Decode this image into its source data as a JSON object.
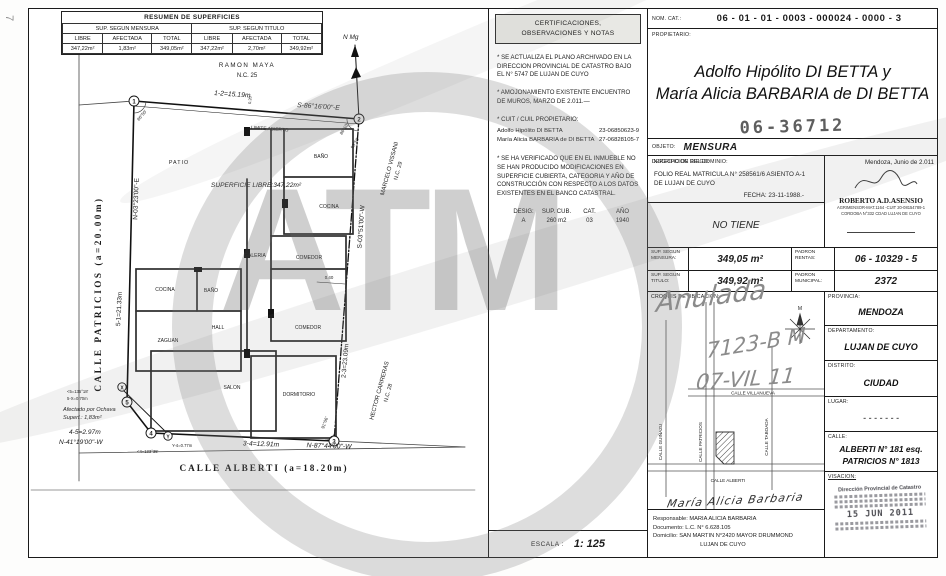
{
  "corner_mark": "7",
  "watermark": {
    "text": "ATM"
  },
  "summary_table": {
    "title": "RESUMEN DE SUPERFICIES",
    "group_mensura": "SUP. SEGUN MENSURA",
    "group_titulo": "SUP. SEGUN TITULO",
    "col_libre": "LIBRE",
    "col_afectada": "AFECTADA",
    "col_total": "TOTAL",
    "mensura": [
      "347,22m²",
      "1,83m²",
      "349,05m²"
    ],
    "titulo": [
      "347,22m²",
      "2,70m²",
      "349,92m²"
    ]
  },
  "plan": {
    "north_label": "N Mg",
    "top_tick": "0.20",
    "street_left": "CALLE  PATRICIOS  (a=20.00m)",
    "street_bottom": "CALLE  ALBERTI   (a=18.20m)",
    "neighbor_top": "RAMON  MAYA",
    "neighbor_top_nc": "N.C. 25",
    "neighbor_right1": "MARCELO VISSANI",
    "neighbor_right1_nc": "N.C. 29",
    "neighbor_right2": "HECTOR CARRERAS",
    "neighbor_right2_nc": "N.C. 28",
    "top_len": "1-2=15.19m",
    "top_bearing": "S-86°16'00\"-E",
    "top_note": "LIMITE ABIERTO",
    "left_bearing": "N-03°23'00\"-E",
    "left_len": "5-1=21.33m",
    "right_bearing": "S-03°51'00\"-W",
    "right_len": "2-3=23.09m",
    "bottom_len": "3-4=12.91m",
    "bottom_bearing": "N-87°44'00\"-W",
    "ochava_len": "4-5=2.97m",
    "ochava_bearing": "N-41°19'00\"-W",
    "ochava_note1": "Afectado por Ochava",
    "ochava_note2": "Superf.: 1,83m²",
    "ang_5": "<5=135°18'",
    "len_5x": "5-X=0.70m",
    "ang_4": "<4=133°35'",
    "len_y4": "Y-4=0.77m",
    "angles": [
      "86°50'",
      "86°10'",
      "93°50'",
      "91°06'"
    ],
    "superficie_libre": "SUPERFICIE LIBRE:347,22m²",
    "vertices": [
      "1",
      "2",
      "3",
      "4",
      "5"
    ],
    "aux_vertices": [
      "X",
      "Y"
    ],
    "rooms": [
      "PATIO",
      "BAÑO",
      "COCINA",
      "GALERIA",
      "COMEDOR",
      "0.40",
      "COCINA",
      "BAÑO",
      "HALL",
      "ZAGUAN",
      "COMEDOR",
      "SALON",
      "DORMITORIO"
    ]
  },
  "certs": {
    "title1": "CERTIFICACIONES,",
    "title2": "OBSERVACIONES  Y  NOTAS",
    "note1": "* SE ACTUALIZA EL PLANO ARCHIVADO EN LA DIRECCION PROVINCIAL DE CATASTRO BAJO EL N° 5747 DE LUJAN DE CUYO",
    "note2": "* AMOJONAMIENTO EXISTENTE ENCUENTRO DE MUROS, MARZO DE 2.011.—",
    "cuit_label": "* CUIT / CUIL PROPIETARIO:",
    "cuit_rows": [
      {
        "name": "Adolfo Hipólito DI BETTA",
        "num": "23-06850623-9"
      },
      {
        "name": "María Alicia BARBARIA de DI BETTA",
        "num": "27-06828105-7"
      }
    ],
    "note3": "* SE HA VERIFICADO QUE EN EL INMUEBLE NO SE HAN PRODUCIDO MODIFICACIONES EN SUPERFICIE CUBIERTA, CATEGORIA Y AÑO DE CONSTRUCCIÓN CON RESPECTO A LOS DATOS EXISTENTES EN EL BANCO CATASTRAL.",
    "desig_headers": [
      "DESIG:",
      "SUP. CUB.",
      "CAT.",
      "AÑO"
    ],
    "desig_values": [
      "A",
      "260 m2",
      "03",
      "1940"
    ]
  },
  "escala": {
    "label": "ESCALA :",
    "value": "1: 125"
  },
  "nomcat": {
    "label": "NOM.  CAT.:",
    "value": "06 - 01 - 01 - 0003 - 000024 - 0000 - 3"
  },
  "owner": {
    "label": "PROPIETARIO:",
    "line1": "Adolfo Hipólito DI BETTA y",
    "line2": "María Alicia BARBARIA de DI BETTA",
    "stamp": "06-36712"
  },
  "objeto": {
    "label": "OBJETO:",
    "value": "MENSURA"
  },
  "dominio": {
    "label": "INSCRIPCION DEL DOMINIO:",
    "line1": "FOLIO REAL MATRICULA N° 258561/6  ASIENTO A-1",
    "line2": "DE LUJAN DE CUYO",
    "fecha": "FECHA: 23-11-1988.-"
  },
  "firma": {
    "date": "Mendoza, Junio de 2.011",
    "name": "ROBERTO  A.D.ASENSIO",
    "line1": "AGRIMENSOR-MAT.1164  -CUIT 20-08154789-1",
    "line2": "CORDOBA N°332 CDAD LUJAN DE CUYO"
  },
  "riego": {
    "label": "DERECHO DE RIEGO:",
    "value": "NO TIENE"
  },
  "sups": {
    "mensura_label": "SUP.  SEGUN MENSURA:",
    "mensura_value": "349,05 m²",
    "rentas_label": "PADRON RENTAS:",
    "rentas_value": "06 - 10329 - 5",
    "titulo_label": "SUP.  SEGUN TITULO:",
    "titulo_value": "349,92 m²",
    "municipal_label": "PADRON MUNICIPAL:",
    "municipal_value": "2372"
  },
  "croquis": {
    "label": "CROQUIS  DE  UBICACION:",
    "street_v1": "CALLE GUIÑAZU",
    "street_v2": "CALLE PATRICIOS",
    "street_v3": "CALLE TABOADA",
    "street_h1": "CALLE VILLANUEVA",
    "street_h2": "CALLE ALBERTI",
    "compass": "M",
    "handwriting1": "Anulada",
    "handwriting2": "7123-B M",
    "handwriting3": "07-VIL 11"
  },
  "location": {
    "provincia_label": "PROVINCIA:",
    "provincia": "MENDOZA",
    "departamento_label": "DEPARTAMENTO:",
    "departamento": "LUJAN DE CUYO",
    "distrito_label": "DISTRITO:",
    "distrito": "CIUDAD",
    "lugar_label": "LUGAR:",
    "lugar": "- - - - - - -",
    "calle_label": "CALLE:",
    "calle1": "ALBERTI N° 181 esq.",
    "calle2": "PATRICIOS N° 1813"
  },
  "responsable": {
    "signature": "María Alicia Barbaria",
    "line1": "Responsable: MARIA  ALICIA  BARBARIA",
    "line2": "Documento:  L.C.  N°  6.628.105",
    "line3": "Domicilio: SAN  MARTIN  N°2420  MAYOR  DRUMMOND",
    "line4": "LUJAN  DE  CUYO"
  },
  "visacion": {
    "label": "VISACION:",
    "stamp_line1": "Dirección Provincial de Catastro",
    "stamp_date": "15 JUN 2011"
  }
}
